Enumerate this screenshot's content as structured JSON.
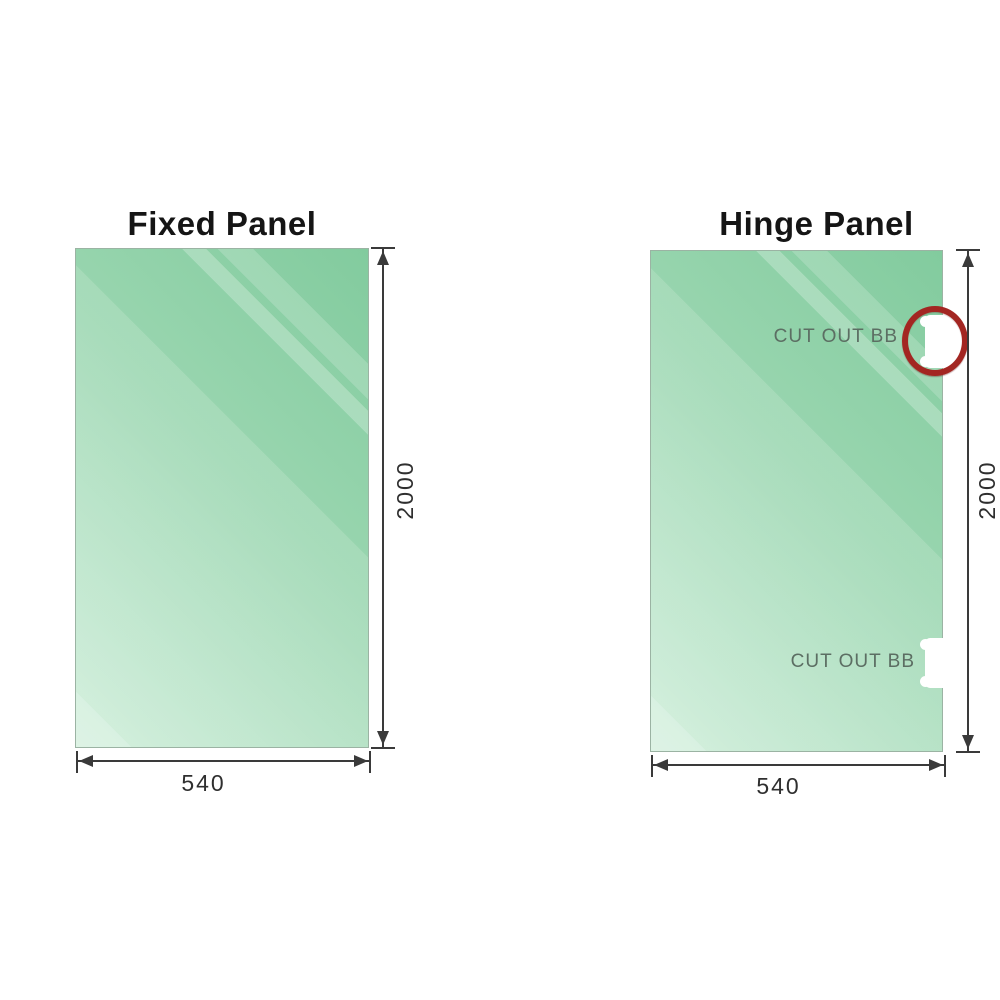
{
  "diagram": {
    "fixed_panel": {
      "title": "Fixed Panel",
      "width_mm": "540",
      "height_mm": "2000"
    },
    "hinge_panel": {
      "title": "Hinge Panel",
      "width_mm": "540",
      "height_mm": "2000",
      "cutout_top_label": "CUT OUT BB",
      "cutout_bottom_label": "CUT OUT BB"
    },
    "colors": {
      "glass_dark": "#82cb9e",
      "glass_light": "#cfeeda",
      "dimension": "#3a3a3a",
      "annotation_circle": "#a32622",
      "cutout_label": "#5c6e63"
    }
  }
}
